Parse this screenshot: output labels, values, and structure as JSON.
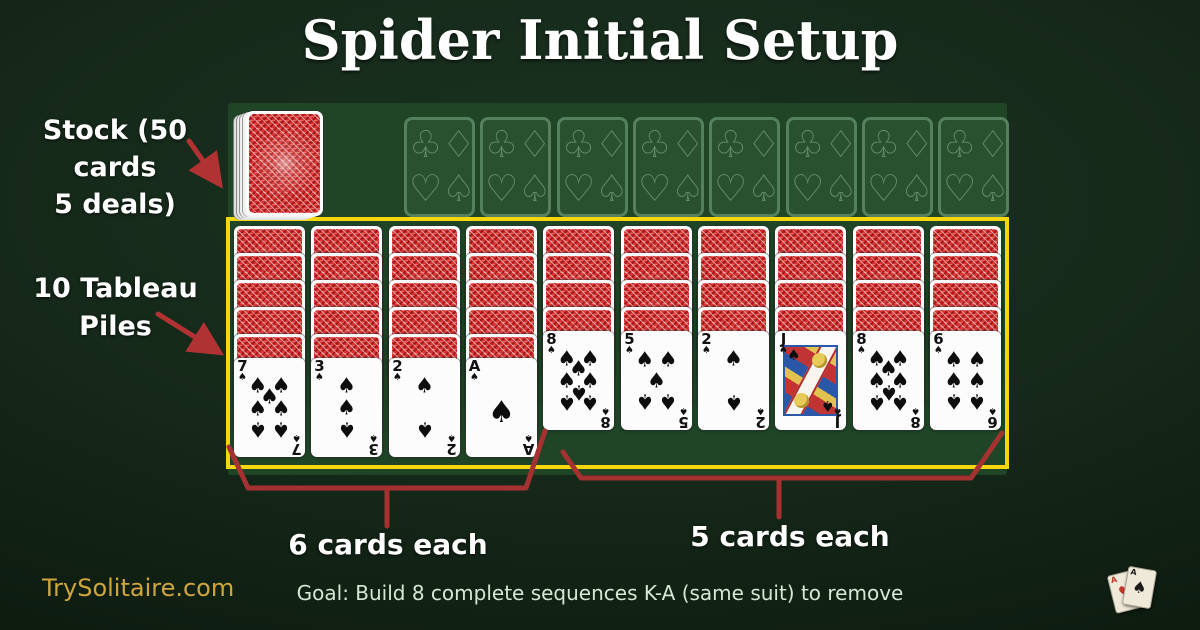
{
  "title": "Spider Initial Setup",
  "stock": {
    "label_line1": "Stock (50 cards",
    "label_line2": "5 deals)"
  },
  "foundations": {
    "slots": 8,
    "suit_outlines": [
      {
        "name": "club",
        "glyph": "♧"
      },
      {
        "name": "diamond",
        "glyph": "♢"
      },
      {
        "name": "heart",
        "glyph": "♡"
      },
      {
        "name": "spade",
        "glyph": "♤"
      }
    ]
  },
  "tableau": {
    "label_line1": "10 Tableau",
    "label_line2": "Piles",
    "piles": [
      {
        "facedown": 5,
        "rank": "7",
        "suit": "♠"
      },
      {
        "facedown": 5,
        "rank": "3",
        "suit": "♠"
      },
      {
        "facedown": 5,
        "rank": "2",
        "suit": "♠"
      },
      {
        "facedown": 5,
        "rank": "A",
        "suit": "♠"
      },
      {
        "facedown": 4,
        "rank": "8",
        "suit": "♠"
      },
      {
        "facedown": 4,
        "rank": "5",
        "suit": "♠"
      },
      {
        "facedown": 4,
        "rank": "2",
        "suit": "♠"
      },
      {
        "facedown": 4,
        "rank": "J",
        "suit": "♠"
      },
      {
        "facedown": 4,
        "rank": "8",
        "suit": "♠"
      },
      {
        "facedown": 4,
        "rank": "6",
        "suit": "♠"
      }
    ]
  },
  "braces": {
    "six_label": "6 cards each",
    "five_label": "5 cards each"
  },
  "footer": {
    "site": "TrySolitaire.com",
    "goal": "Goal: Build 8 complete sequences K-A (same suit) to remove",
    "logo_cards": [
      {
        "rank": "A",
        "suit": "♥",
        "color": "#c0392b"
      },
      {
        "rank": "A",
        "suit": "♠",
        "color": "#1c1c1c"
      }
    ]
  },
  "colors": {
    "felt_green": "#1f4526",
    "tableau_outline_yellow": "#f6d70e",
    "annotation_red": "#b13232",
    "card_back_red": "#d53535",
    "site_gold": "#cfa63e"
  }
}
